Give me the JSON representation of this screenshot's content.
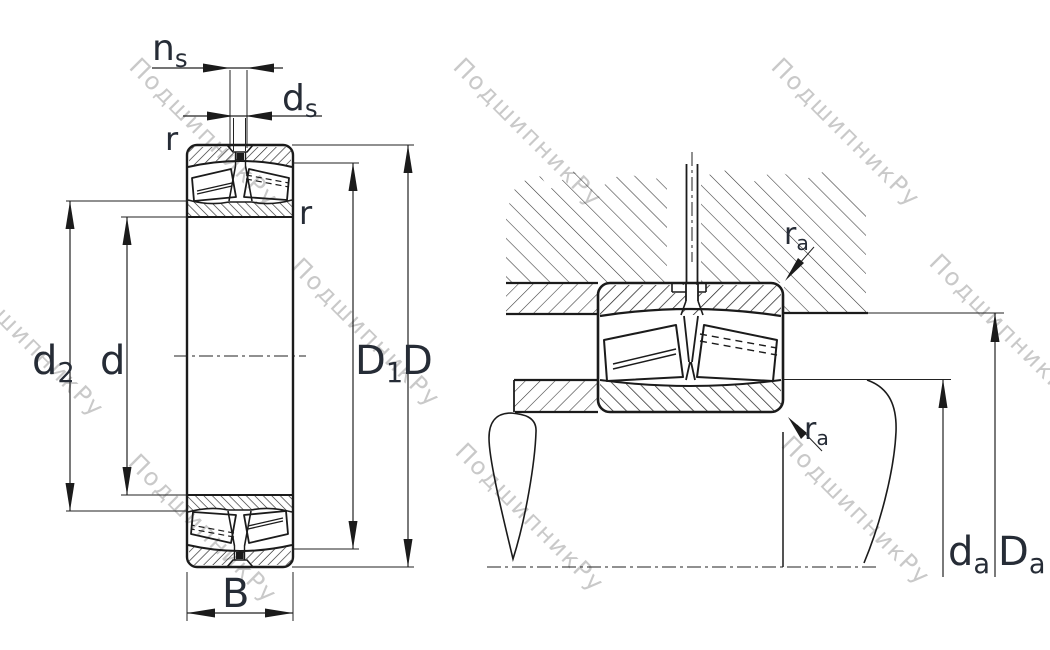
{
  "watermark": {
    "text": "ПодшипникРу",
    "color": "#c9c9c9"
  },
  "labels": {
    "ns": {
      "main": "n",
      "sub": "s"
    },
    "ds": {
      "main": "d",
      "sub": "s"
    },
    "r": {
      "main": "r",
      "sub": ""
    },
    "d2": {
      "main": "d",
      "sub": "2"
    },
    "d": {
      "main": "d",
      "sub": ""
    },
    "D1": {
      "main": "D",
      "sub": "1"
    },
    "D": {
      "main": "D",
      "sub": ""
    },
    "B": {
      "main": "B",
      "sub": ""
    },
    "ra": {
      "main": "r",
      "sub": "a"
    },
    "da": {
      "main": "d",
      "sub": "a"
    },
    "Da": {
      "main": "D",
      "sub": "a"
    }
  },
  "colors": {
    "ink": "#1b1b1b",
    "label": "#262c36",
    "watermark": "#c9c9c9",
    "background": "#ffffff"
  }
}
